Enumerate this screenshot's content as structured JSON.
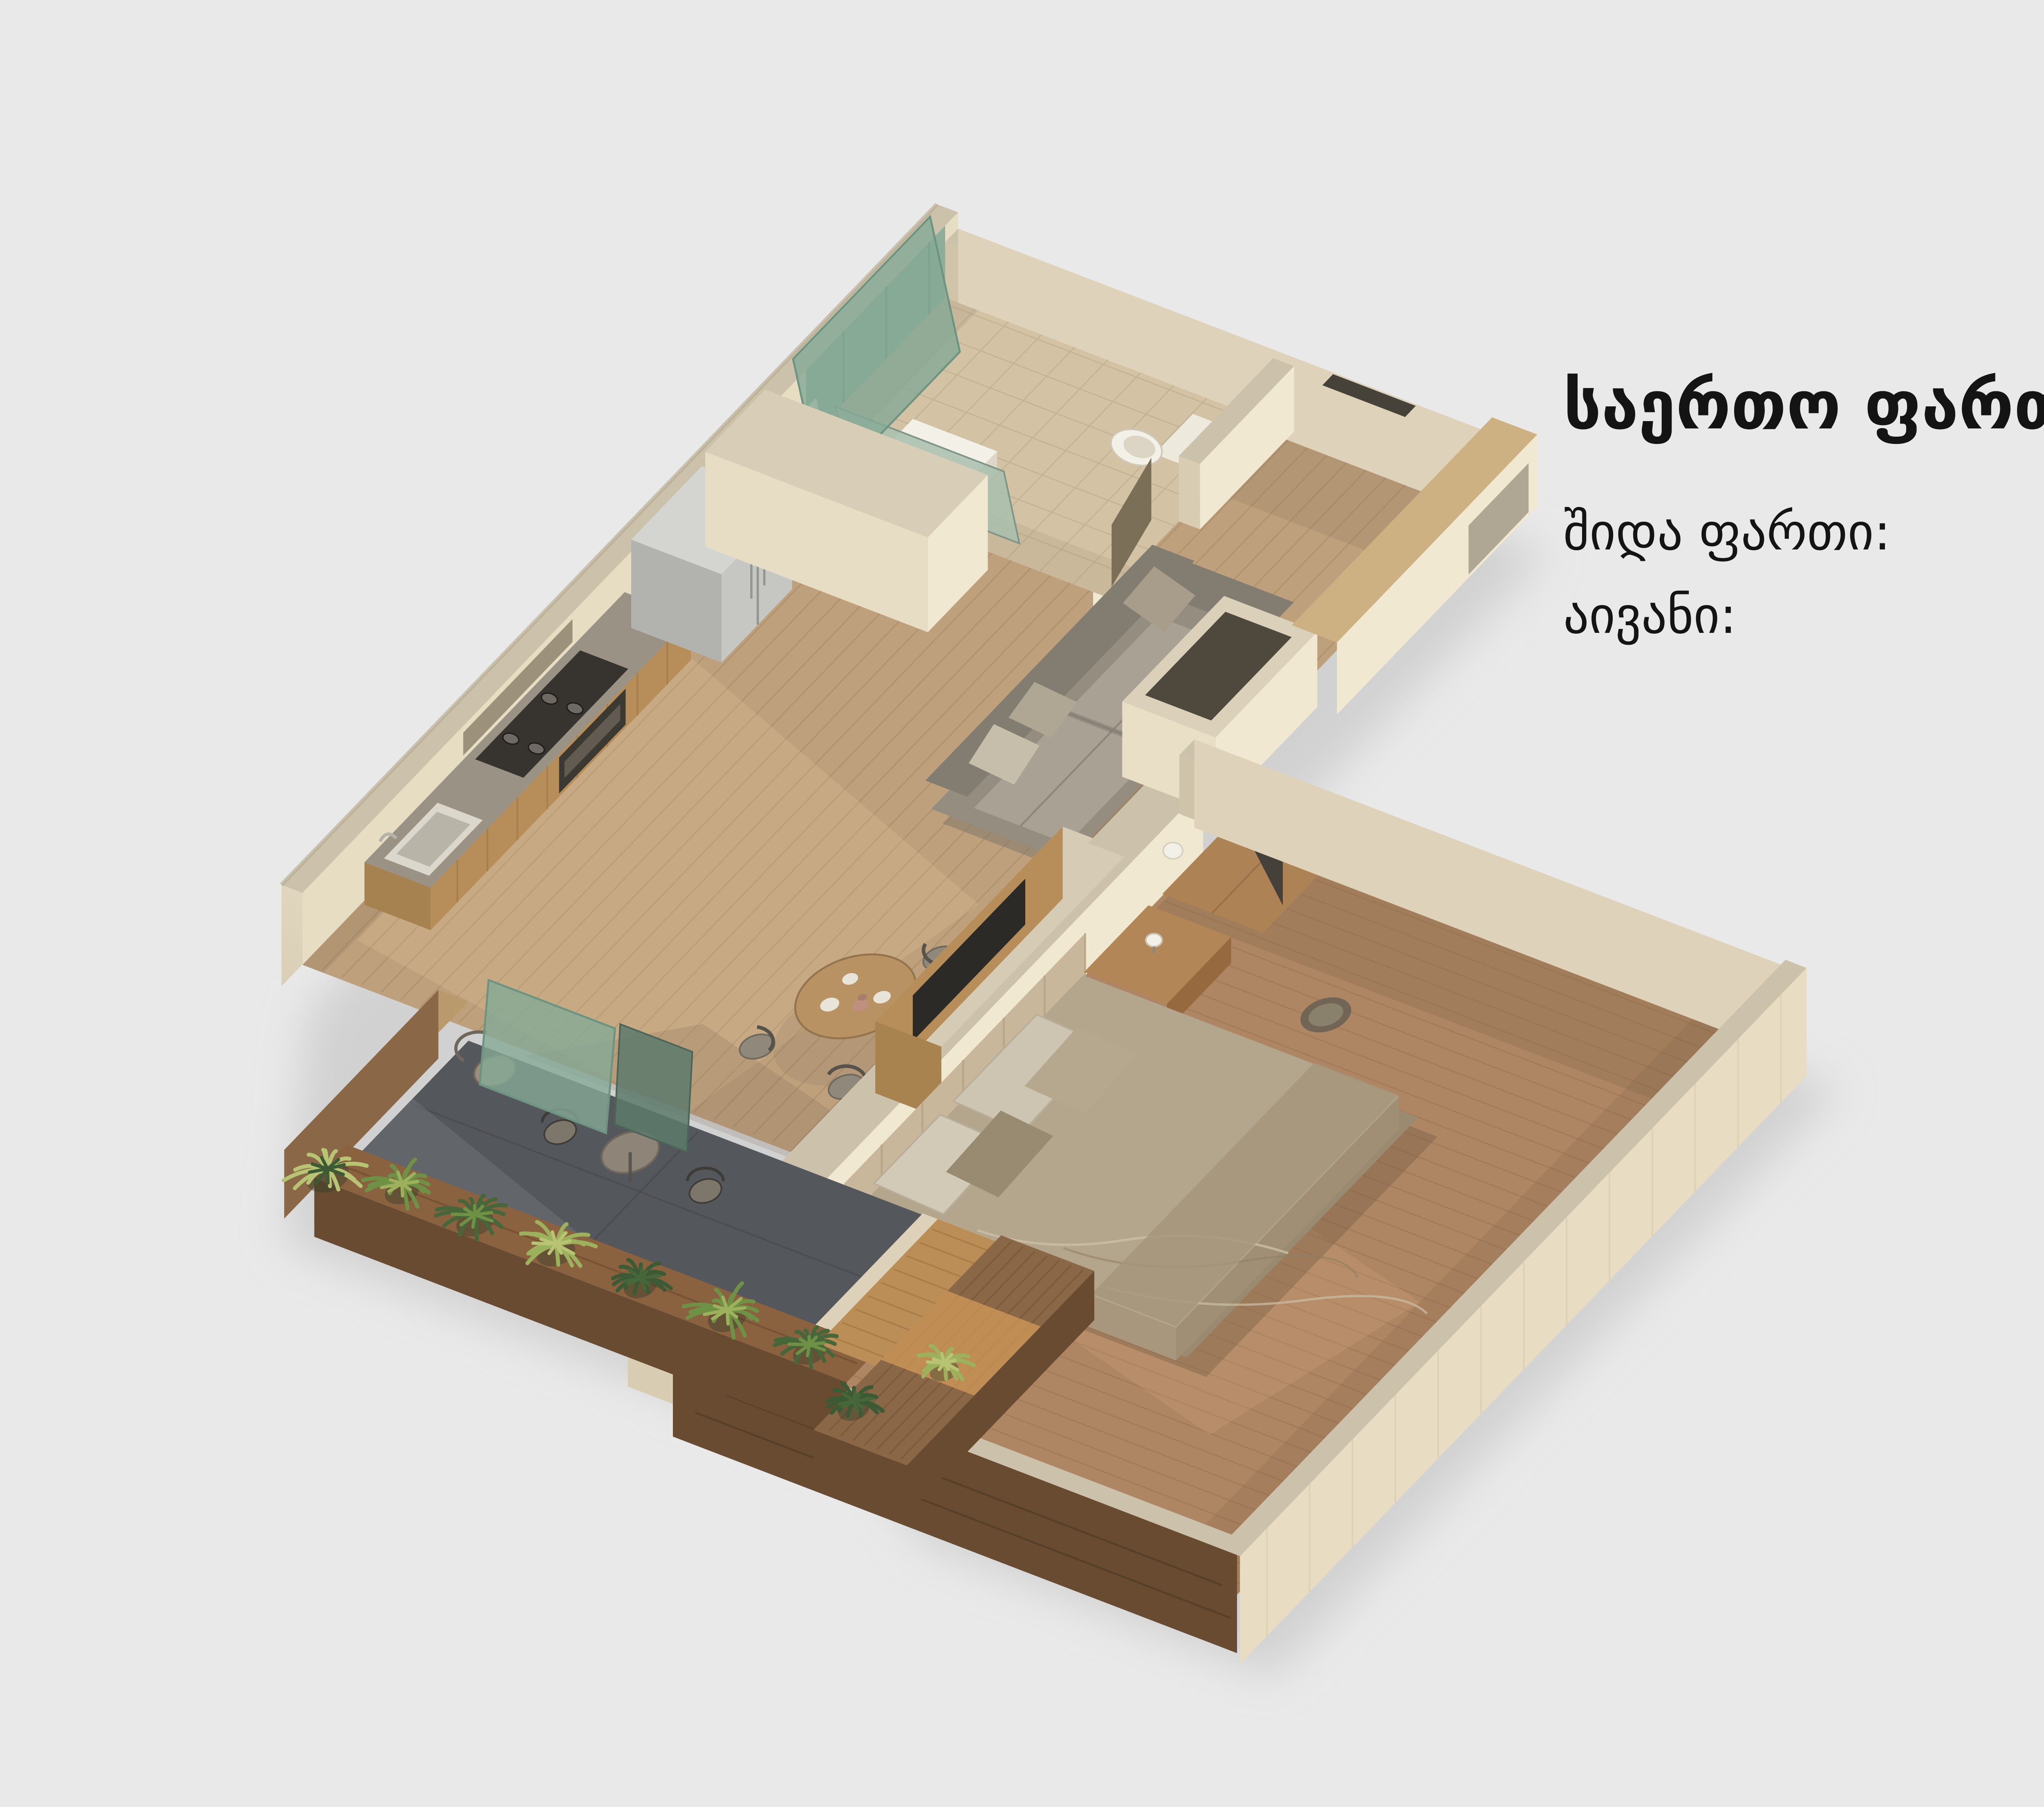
{
  "page": {
    "background": "#e9e9e9"
  },
  "stats": {
    "text_color": "#141414",
    "title": {
      "label": "საერთო ფართი:",
      "value": "43.2",
      "unit": "მ",
      "sup": "2"
    },
    "rows": [
      {
        "label": "შიდა ფართი:",
        "value": "37.3",
        "unit": "მ",
        "sup": "2"
      },
      {
        "label": "აივანი:",
        "value": "5.9",
        "unit": "მ",
        "sup": "2"
      }
    ]
  },
  "palette": {
    "background": "#e9e9e9",
    "wall_face": "#f1e8d2",
    "wall_top": "#ccc2ac",
    "wall_side": "#ded3ba",
    "wall_inner": "#e7ddc3",
    "wall_shadow": "#cfc3a9",
    "wood_living": "#bfa07d",
    "wood_line": "#8f7356",
    "wood_bedroom": "#ae8663",
    "wood_bed_line": "#8a6548",
    "tile_bath": "#d3c2a4",
    "tile_line": "#b3a385",
    "slate_balcony": "#54575b",
    "deck_wood": "#bb8d57",
    "brick_dark": "#684b31",
    "brick_light": "#8a6747",
    "stone_curb": "#ddd2b9",
    "glass_teal": "#85a996",
    "glass_edge": "#6d9480",
    "sofa": "#948d80",
    "sofa_light": "#a9a294",
    "sofa_dark": "#837c70",
    "pillow": "#c7bdab",
    "bed_duvet": "#b3a68d",
    "bed_pillow": "#d2c9b7",
    "fridge": "#c6c6c3",
    "counter_top": "#9a9284",
    "cabinet_wood": "#b78e59",
    "cooktop": "#37342f",
    "fixture_white": "#f3f0e8",
    "plant_greens": [
      "#47663a",
      "#6f9146",
      "#9db05c",
      "#b8c373",
      "#3c5a33"
    ],
    "shadow": "#bdbdbd",
    "door_dark": "#45403a",
    "headboard": "#c9b79c"
  }
}
